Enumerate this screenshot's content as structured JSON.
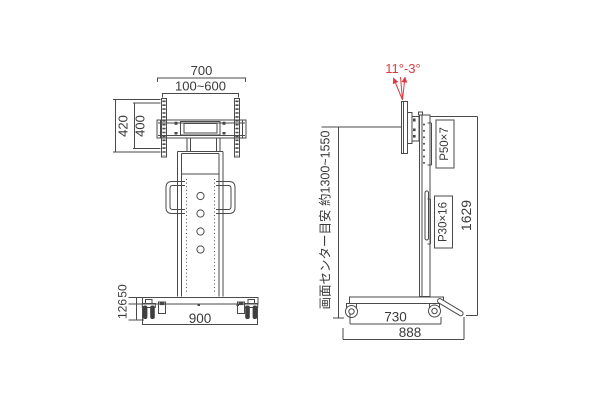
{
  "drawing": {
    "accent_red": "#db3b40",
    "line_color": "#4a4a4a",
    "front_view": {
      "dim_top_width": "700",
      "dim_vesa_width_range": "100~600",
      "dim_bracket_height_outer": "420",
      "dim_bracket_height_inner": "400",
      "dim_base_width": "900",
      "dim_base_frame_height": "50",
      "dim_caster_height": "126"
    },
    "side_view": {
      "tilt_range": "11°-3°",
      "hole_pitch_upper": "P50×7",
      "hole_pitch_lower": "P30×16",
      "dim_total_height": "1629",
      "screen_center_note": "画面センター目安 約1300~1550",
      "dim_base_depth": "730",
      "dim_overall_depth": "888"
    }
  }
}
